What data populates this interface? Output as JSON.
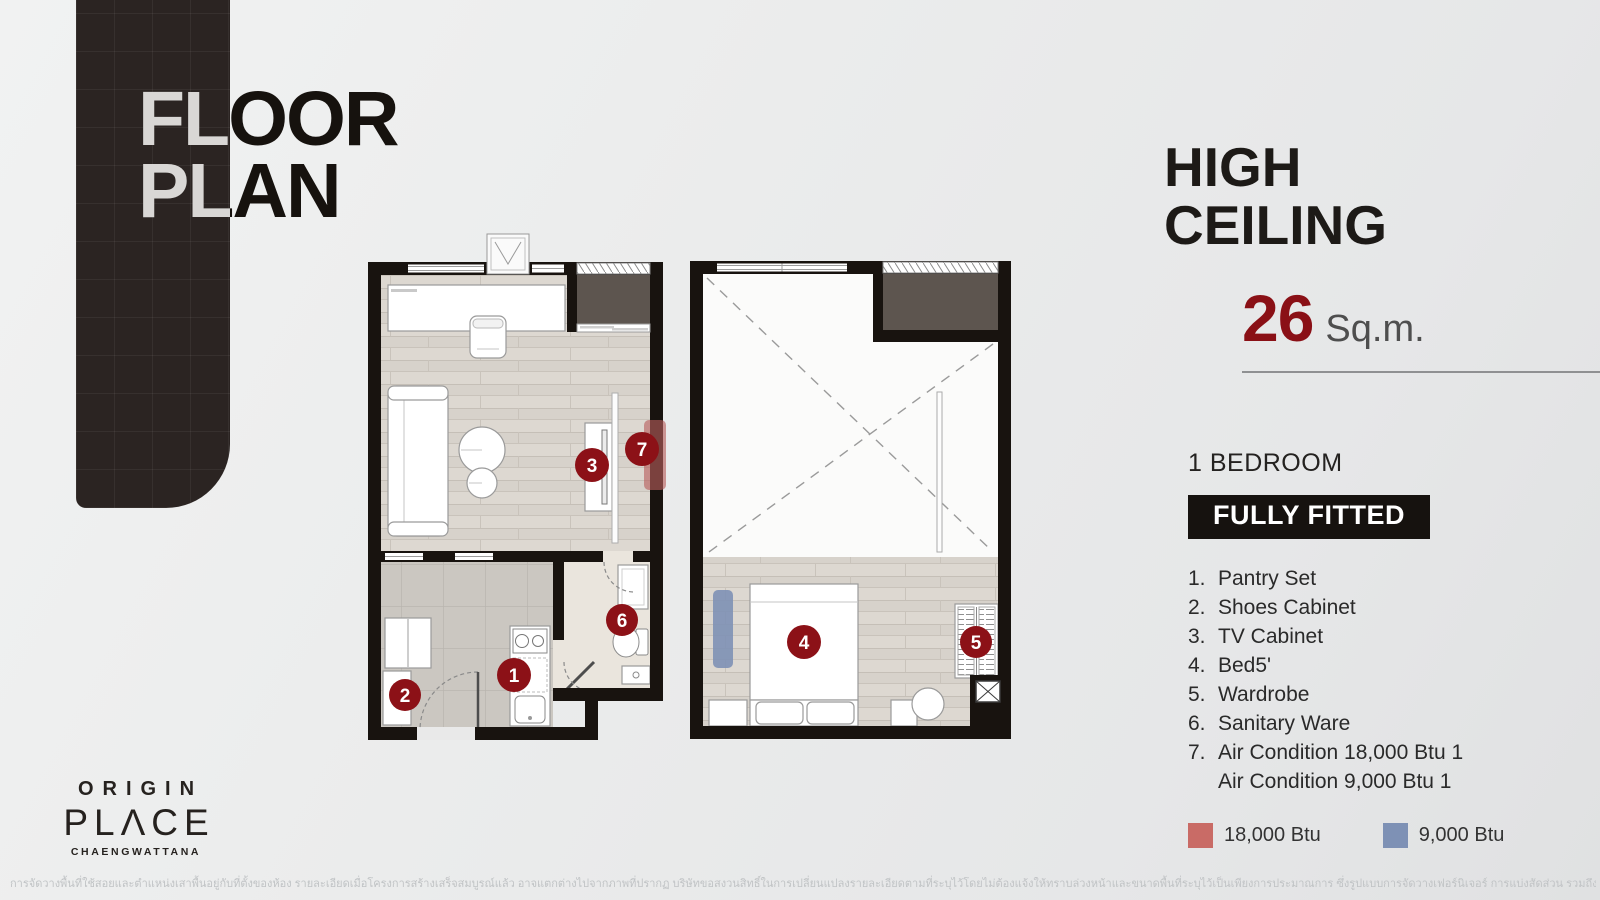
{
  "title": {
    "line1": "FLOOR",
    "line2": "PLAN"
  },
  "right_panel": {
    "heading_line1": "HIGH",
    "heading_line2": "CEILING",
    "area_value": "26",
    "area_unit": "Sq.m.",
    "bedroom_label": "1 BEDROOM",
    "badge_label": "FULLY FITTED",
    "items": [
      {
        "num": "1.",
        "label": "Pantry Set"
      },
      {
        "num": "2.",
        "label": "Shoes Cabinet"
      },
      {
        "num": "3.",
        "label": "TV Cabinet"
      },
      {
        "num": "4.",
        "label": "Bed5'"
      },
      {
        "num": "5.",
        "label": "Wardrobe"
      },
      {
        "num": "6.",
        "label": "Sanitary Ware"
      },
      {
        "num": "7.",
        "label": "Air Condition 18,000 Btu 1"
      },
      {
        "num": "",
        "label": "Air Condition 9,000 Btu 1"
      }
    ],
    "legend": [
      {
        "label": "18,000 Btu",
        "color": "#c96b66"
      },
      {
        "label": "9,000 Btu",
        "color": "#7e91b5"
      }
    ]
  },
  "plan_markers": {
    "m1": "1",
    "m2": "2",
    "m3": "3",
    "m4": "4",
    "m5": "5",
    "m6": "6",
    "m7": "7"
  },
  "logo": {
    "brand": "ORIGIN",
    "name": "PLΛCE",
    "sub": "CHAENGWATTANA"
  },
  "footer": {
    "disclaimer": "การจัดวางพื้นที่ใช้สอยและตำแหน่งเสาพื้นอยู่กับที่ตั้งของห้อง   รายละเอียดเมื่อโครงการสร้างเสร็จสมบูรณ์แล้ว   อาจแตกต่างไปจากภาพที่ปรากฏ บริษัทขอสงวนสิทธิ์ในการเปลี่ยนแปลงรายละเอียดตามที่ระบุไว้โดยไม่ต้องแจ้งให้ทราบล่วงหน้าและขนาดพื้นที่ระบุไว้เป็นเพียงการประมาณการ   ซึ่งรูปแบบการจัดวางเฟอร์นิเจอร์ การแบ่งสัดส่วน   รวมถึงรายละเอียดต่างๆเป็นเพียงการแสดงตัวอย่างการจัดวางพื้นที่ใช้สอยและเพื่อการโฆษณาเท่านั้น"
  },
  "colors": {
    "marker_red": "#8c1117",
    "area_red": "#8a1016",
    "ac_red": "#c96b66",
    "ac_blue": "#7e91b5",
    "wall_black": "#18130f",
    "ribbon": "#2b2422"
  }
}
